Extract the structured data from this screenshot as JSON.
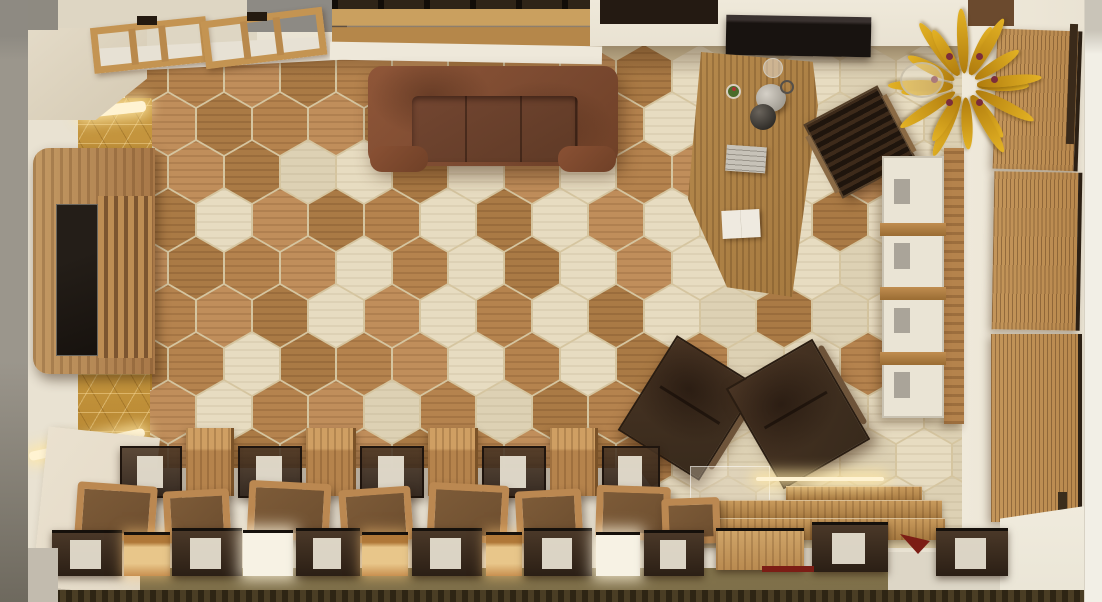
{
  "meta": {
    "title": "Top-down 3D render of a wood-finished showroom interior with hexagon tile floor"
  },
  "palette": {
    "grout": "#d5c5a0",
    "wallCream": "#e9e2d2",
    "ledgeCream": "#ded6c3",
    "grayWall": "#8e8a81",
    "grayStrip": "#9b968c",
    "grayStripDark": "#6e695e",
    "goldWall": "#c6973f",
    "led": "#fff3d2",
    "tvWood": "#a87848",
    "tvScreen": "#17120e",
    "slatLight": "#bd8d54",
    "slatDark": "#7c5530",
    "deskWood": "#a5793f",
    "chairArm": "#8a6a45",
    "loungeDark": "#382a1c",
    "loungeEdge": "#6e543a",
    "shelfWood": "#b5834c",
    "shelfWhite": "#eae4d5",
    "blindWood": "#b9894e",
    "blindFrame": "#2c2014",
    "outerWhite": "#f2efe6",
    "marble": "#e3d9c6",
    "olive": "#7d6e49",
    "baseDark": "#3a301c",
    "caseCard": "#e9e3d4",
    "crateRim": "#bb8851",
    "crateIn": "#6e4f30",
    "boxWood": "#b98a50",
    "red": "#7c1d15",
    "fern1": "#e3b224",
    "fern2": "#b07c0e",
    "berry": "#7c2d3a",
    "whiteFloor": "#eae5d6"
  },
  "floor": {
    "origin_x": 140,
    "origin_y": 76,
    "col_step": 56,
    "row_step": 48,
    "odd_offset": 28,
    "cols": 16,
    "rows": 10,
    "tile_w": 54,
    "tile_h": 62,
    "cream_zone_min_x": 658,
    "cream_tiles": [
      [
        1,
        3
      ],
      [
        3,
        2
      ],
      [
        4,
        2
      ],
      [
        5,
        1
      ],
      [
        5,
        3
      ],
      [
        6,
        2
      ],
      [
        7,
        3
      ],
      [
        8,
        2
      ],
      [
        4,
        4
      ],
      [
        6,
        4
      ],
      [
        8,
        4
      ],
      [
        3,
        5
      ],
      [
        5,
        5
      ],
      [
        7,
        5
      ],
      [
        2,
        6
      ],
      [
        6,
        6
      ],
      [
        8,
        6
      ],
      [
        1,
        7
      ],
      [
        4,
        7
      ],
      [
        6,
        7
      ]
    ],
    "wood_tiles": [
      [
        10,
        2
      ],
      [
        12,
        3
      ],
      [
        13,
        2
      ],
      [
        11,
        5
      ],
      [
        13,
        6
      ],
      [
        14,
        4
      ],
      [
        10,
        6
      ]
    ]
  },
  "top_frames": [
    {
      "x": 92,
      "y": 22,
      "w": 116,
      "h": 46,
      "rot": -6
    },
    {
      "x": 203,
      "y": 14,
      "w": 122,
      "h": 48,
      "rot": -7
    }
  ],
  "blinds": [
    {
      "x": 995,
      "y": 30,
      "w": 85,
      "h": 140,
      "rot": 2
    },
    {
      "x": 993,
      "y": 172,
      "w": 88,
      "h": 158,
      "rot": 1
    },
    {
      "x": 991,
      "y": 334,
      "w": 91,
      "h": 188,
      "rot": 0
    }
  ],
  "shelf": {
    "x": 882,
    "y": 156,
    "w": 62,
    "h": 262,
    "compartments": 4
  },
  "fern": {
    "cx": 75,
    "cy": 72,
    "leaves": 18,
    "berries": 6
  },
  "steps": [
    {
      "x": 786,
      "y": 486,
      "w": 136,
      "h": 16
    },
    {
      "x": 712,
      "y": 500,
      "w": 230,
      "h": 20
    },
    {
      "x": 698,
      "y": 518,
      "w": 247,
      "h": 22
    }
  ],
  "display": {
    "cases_y": 446,
    "cases_h": 52,
    "cases": [
      {
        "x": 120,
        "w": 62
      },
      {
        "x": 238,
        "w": 64
      },
      {
        "x": 360,
        "w": 64
      },
      {
        "x": 482,
        "w": 64
      },
      {
        "x": 602,
        "w": 58
      }
    ],
    "cubes_y": 428,
    "cubes_h": 68,
    "cubes": [
      {
        "x": 186,
        "w": 48
      },
      {
        "x": 306,
        "w": 50
      },
      {
        "x": 428,
        "w": 50
      },
      {
        "x": 550,
        "w": 48
      }
    ],
    "crates": [
      {
        "x": 76,
        "y": 484,
        "w": 80,
        "h": 56,
        "rot": 4
      },
      {
        "x": 164,
        "y": 490,
        "w": 66,
        "h": 52,
        "rot": -3
      },
      {
        "x": 248,
        "y": 482,
        "w": 82,
        "h": 58,
        "rot": 3
      },
      {
        "x": 340,
        "y": 488,
        "w": 72,
        "h": 54,
        "rot": -4
      },
      {
        "x": 428,
        "y": 484,
        "w": 80,
        "h": 58,
        "rot": 3
      },
      {
        "x": 516,
        "y": 490,
        "w": 66,
        "h": 52,
        "rot": -3
      },
      {
        "x": 596,
        "y": 486,
        "w": 74,
        "h": 54,
        "rot": 2
      },
      {
        "x": 662,
        "y": 498,
        "w": 58,
        "h": 46,
        "rot": -2
      }
    ],
    "front": [
      {
        "x": 52,
        "y": 530,
        "w": 70,
        "h": 46,
        "t": "dark"
      },
      {
        "x": 124,
        "y": 532,
        "w": 46,
        "h": 44,
        "t": "lit"
      },
      {
        "x": 172,
        "y": 528,
        "w": 70,
        "h": 48,
        "t": "dark"
      },
      {
        "x": 243,
        "y": 530,
        "w": 50,
        "h": 46,
        "t": "white"
      },
      {
        "x": 296,
        "y": 528,
        "w": 64,
        "h": 48,
        "t": "dark"
      },
      {
        "x": 362,
        "y": 532,
        "w": 46,
        "h": 44,
        "t": "lit"
      },
      {
        "x": 412,
        "y": 528,
        "w": 70,
        "h": 48,
        "t": "dark"
      },
      {
        "x": 486,
        "y": 532,
        "w": 36,
        "h": 44,
        "t": "lit"
      },
      {
        "x": 524,
        "y": 528,
        "w": 68,
        "h": 48,
        "t": "dark"
      },
      {
        "x": 596,
        "y": 532,
        "w": 44,
        "h": 44,
        "t": "white"
      },
      {
        "x": 644,
        "y": 530,
        "w": 60,
        "h": 46,
        "t": "dark"
      },
      {
        "x": 716,
        "y": 528,
        "w": 88,
        "h": 42,
        "t": "wood"
      },
      {
        "x": 812,
        "y": 522,
        "w": 76,
        "h": 50,
        "t": "dark"
      },
      {
        "x": 936,
        "y": 528,
        "w": 72,
        "h": 48,
        "t": "dark"
      }
    ]
  }
}
